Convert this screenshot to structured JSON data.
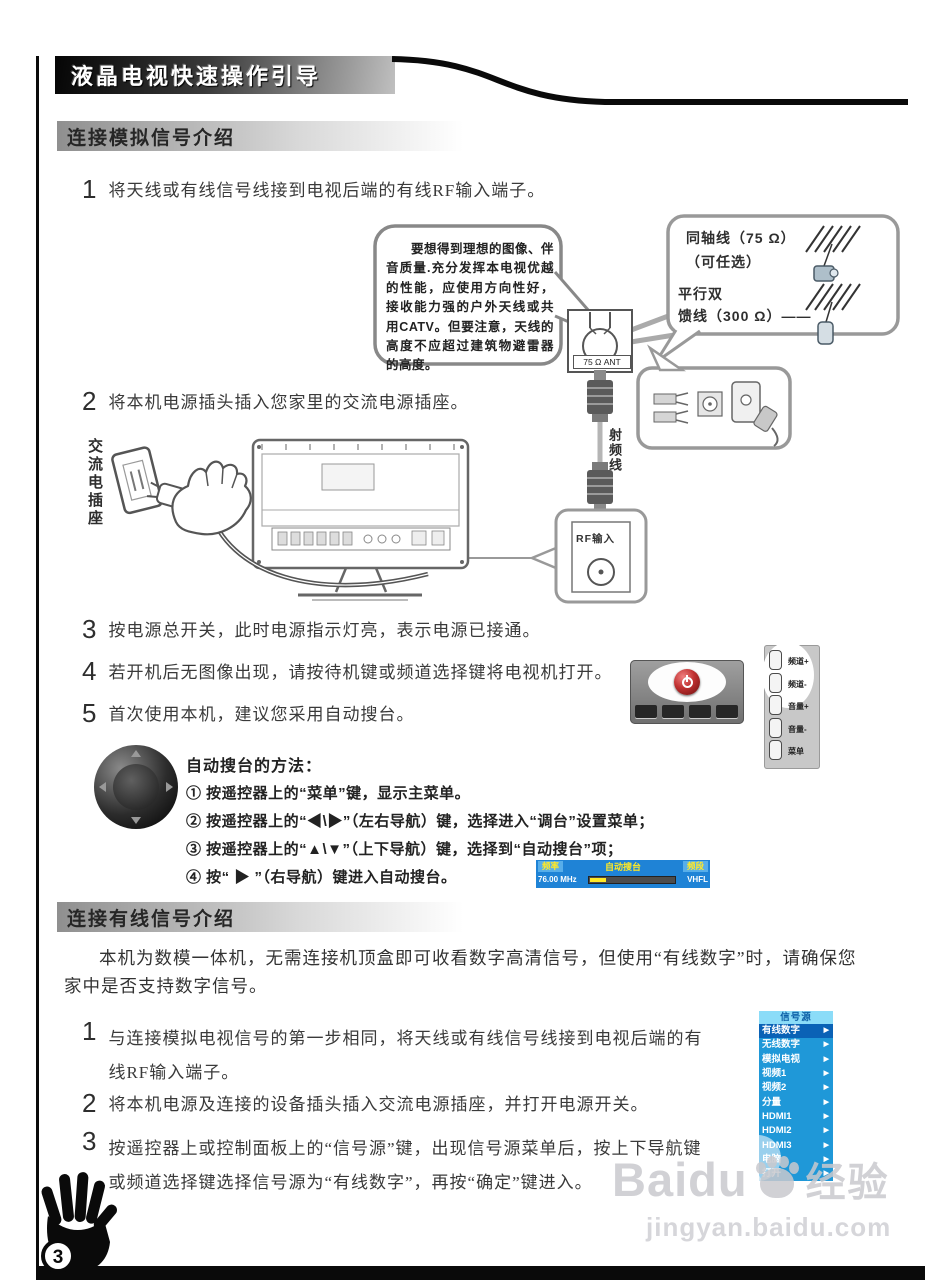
{
  "header": {
    "title": "液晶电视快速操作引导"
  },
  "page_num": "3",
  "sec1": {
    "title": "连接模拟信号介绍",
    "steps": [
      {
        "num": "1",
        "text": "将天线或有线信号线接到电视后端的有线RF输入端子。"
      },
      {
        "num": "2",
        "text": "将本机电源插头插入您家里的交流电源插座。"
      },
      {
        "num": "3",
        "text": "按电源总开关，此时电源指示灯亮，表示电源已接通。"
      },
      {
        "num": "4",
        "text": "若开机后无图像出现，请按待机键或频道选择键将电视机打开。"
      },
      {
        "num": "5",
        "text": "首次使用本机，建议您采用自动搜台。"
      }
    ],
    "bubble": "要想得到理想的图像、伴音质量.充分发挥本电视优越的性能，应使用方向性好，接收能力强的户外天线或共用CATV。但要注意，天线的高度不应超过建筑物避雷器的高度。",
    "cable_box": {
      "l1": "同轴线（75 Ω）",
      "l2": "（可任选）",
      "l3": "平行双",
      "l4": "馈线（300 Ω）——"
    },
    "labels": {
      "ant": "75 Ω ANT",
      "ac_socket": "交流电插座",
      "rf_cable": "射频线",
      "rf_input": "RF输入"
    },
    "side_buttons": [
      "频道+",
      "频道-",
      "音量+",
      "音量-",
      "菜单"
    ],
    "auto": {
      "title": "自动搜台的方法：",
      "items": [
        "① 按遥控器上的“菜单”键，显示主菜单。",
        "② 按遥控器上的“◀\\▶”（左右导航）键，选择进入“调台”设置菜单；",
        "③ 按遥控器上的“▲\\▼”（上下导航）键，选择到“自动搜台”项；",
        "④ 按“ ▶ ”（右导航）键进入自动搜台。"
      ]
    },
    "osd": {
      "freq_label": "频率",
      "title": "自动搜台",
      "band_label": "频段",
      "freq_value": "76.00 MHz",
      "band_value": "VHFL"
    }
  },
  "sec2": {
    "title": "连接有线信号介绍",
    "intro": "本机为数模一体机，无需连接机顶盒即可收看数字高清信号，但使用“有线数字”时，请确保您家中是否支持数字信号。",
    "steps": [
      {
        "num": "1",
        "text": "与连接模拟电视信号的第一步相同，将天线或有线信号线接到电视后端的有线RF输入端子。"
      },
      {
        "num": "2",
        "text": "将本机电源及连接的设备插头插入交流电源插座，并打开电源开关。"
      },
      {
        "num": "3",
        "text": "按遥控器上或控制面板上的“信号源”键，出现信号源菜单后，按上下导航键或频道选择键选择信号源为“有线数字”，再按“确定”键进入。"
      }
    ],
    "menu": {
      "title": "信号源",
      "arrow": "▶",
      "items": [
        "有线数字",
        "无线数字",
        "模拟电视",
        "视频1",
        "视频2",
        "分量",
        "HDMI1",
        "HDMI2",
        "HDMI3",
        "电脑",
        "打开"
      ]
    }
  },
  "watermark": {
    "brand": "Baidu",
    "suffix": "经验",
    "url": "jingyan.baidu.com"
  }
}
